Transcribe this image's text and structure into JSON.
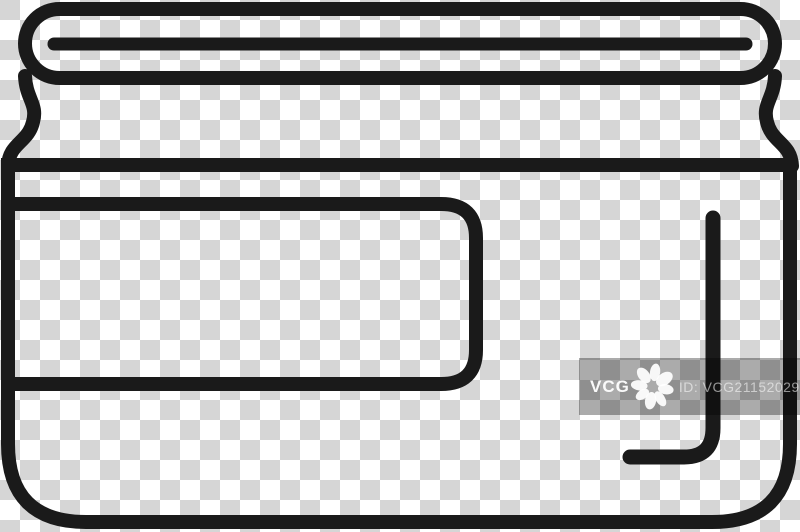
{
  "canvas": {
    "width_px": 800,
    "height_px": 532
  },
  "artwork": {
    "icon_name": "jar-icon",
    "style": "black outline line-art on transparent checkerboard background",
    "parts": [
      "jar-lid",
      "jar-lid-seam",
      "jar-shoulders",
      "jar-body",
      "jar-label-band",
      "jar-highlight-reflection"
    ]
  },
  "watermark": {
    "brand": "VCG",
    "logo_icon": "vcg-flower-icon",
    "id_label": "ID: VCG211520293455"
  },
  "colors": {
    "stroke": "#1a1a1a",
    "checker_light": "#ffffff",
    "checker_dark": "#d6d6d6",
    "watermark_band": "rgba(0,0,0,0.33)",
    "watermark_text": "#ffffff",
    "watermark_id_text": "rgba(255,255,255,0.55)"
  }
}
